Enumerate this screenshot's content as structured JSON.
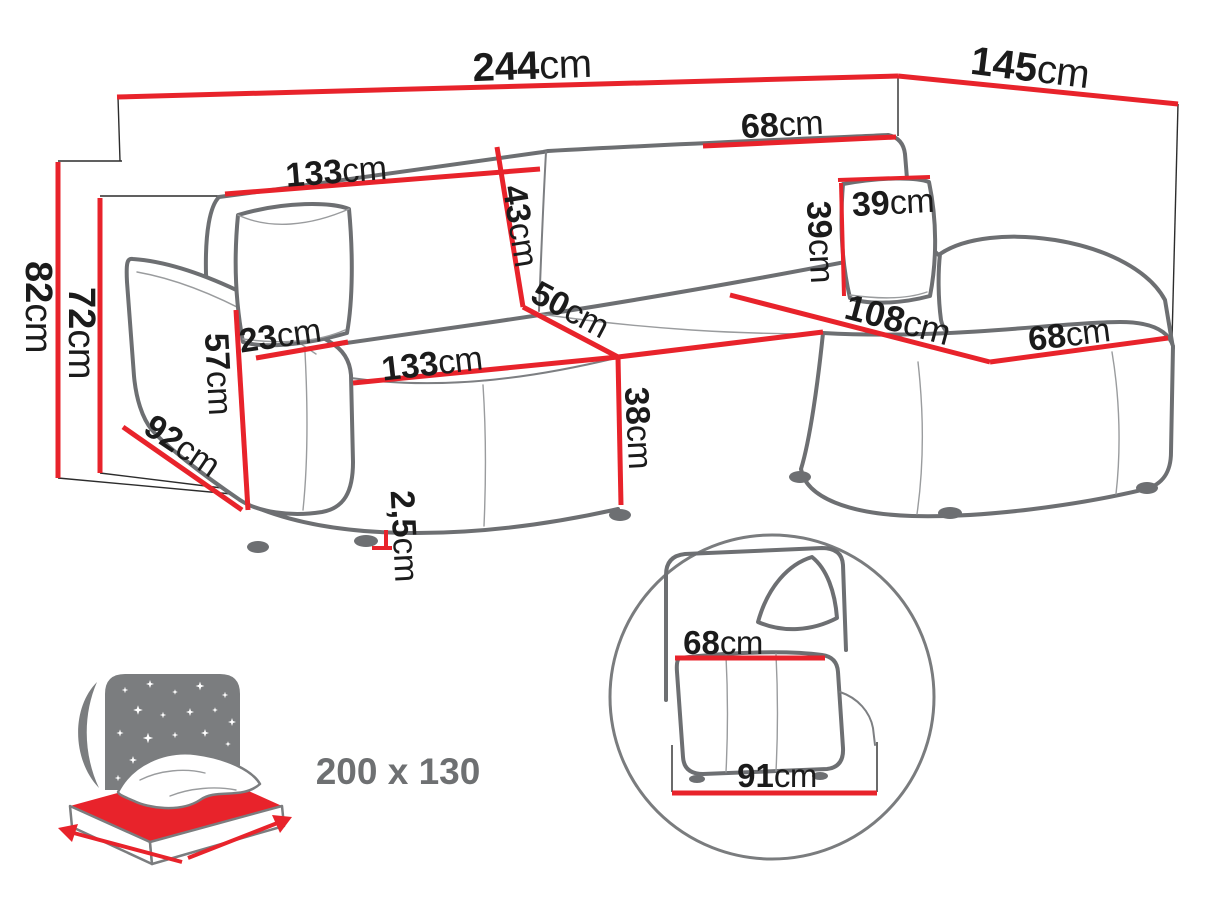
{
  "diagram_title": "corner-sofa-dimensions",
  "unit": "cm",
  "colors": {
    "dimension_red": "#e8232b",
    "outline_gray": "#6d6f72",
    "text_black": "#1b1b1b",
    "muted_gray": "#6e7072"
  },
  "labels": {
    "total_width": {
      "value": "244",
      "unit": "cm"
    },
    "total_depth": {
      "value": "145",
      "unit": "cm"
    },
    "backrest_section_width": {
      "value": "68",
      "unit": "cm"
    },
    "backrest_width": {
      "value": "133",
      "unit": "cm"
    },
    "backrest_height": {
      "value": "43",
      "unit": "cm"
    },
    "cushion_width": {
      "value": "39",
      "unit": "cm"
    },
    "cushion_height": {
      "value": "39",
      "unit": "cm"
    },
    "total_height": {
      "value": "82",
      "unit": "cm"
    },
    "frame_height": {
      "value": "72",
      "unit": "cm"
    },
    "armrest_width": {
      "value": "23",
      "unit": "cm"
    },
    "seat_depth": {
      "value": "50",
      "unit": "cm"
    },
    "chaise_length": {
      "value": "108",
      "unit": "cm"
    },
    "chaise_width": {
      "value": "68",
      "unit": "cm"
    },
    "armrest_height": {
      "value": "57",
      "unit": "cm"
    },
    "seat_width": {
      "value": "133",
      "unit": "cm"
    },
    "side_depth": {
      "value": "92",
      "unit": "cm"
    },
    "seat_height": {
      "value": "38",
      "unit": "cm"
    },
    "leg_height": {
      "value": "2,5",
      "unit": "cm"
    },
    "inset_armrest_top": {
      "value": "68",
      "unit": "cm"
    },
    "inset_armrest_base": {
      "value": "91",
      "unit": "cm"
    },
    "sleeping_area": {
      "value": "200 x 130",
      "unit": ""
    }
  }
}
